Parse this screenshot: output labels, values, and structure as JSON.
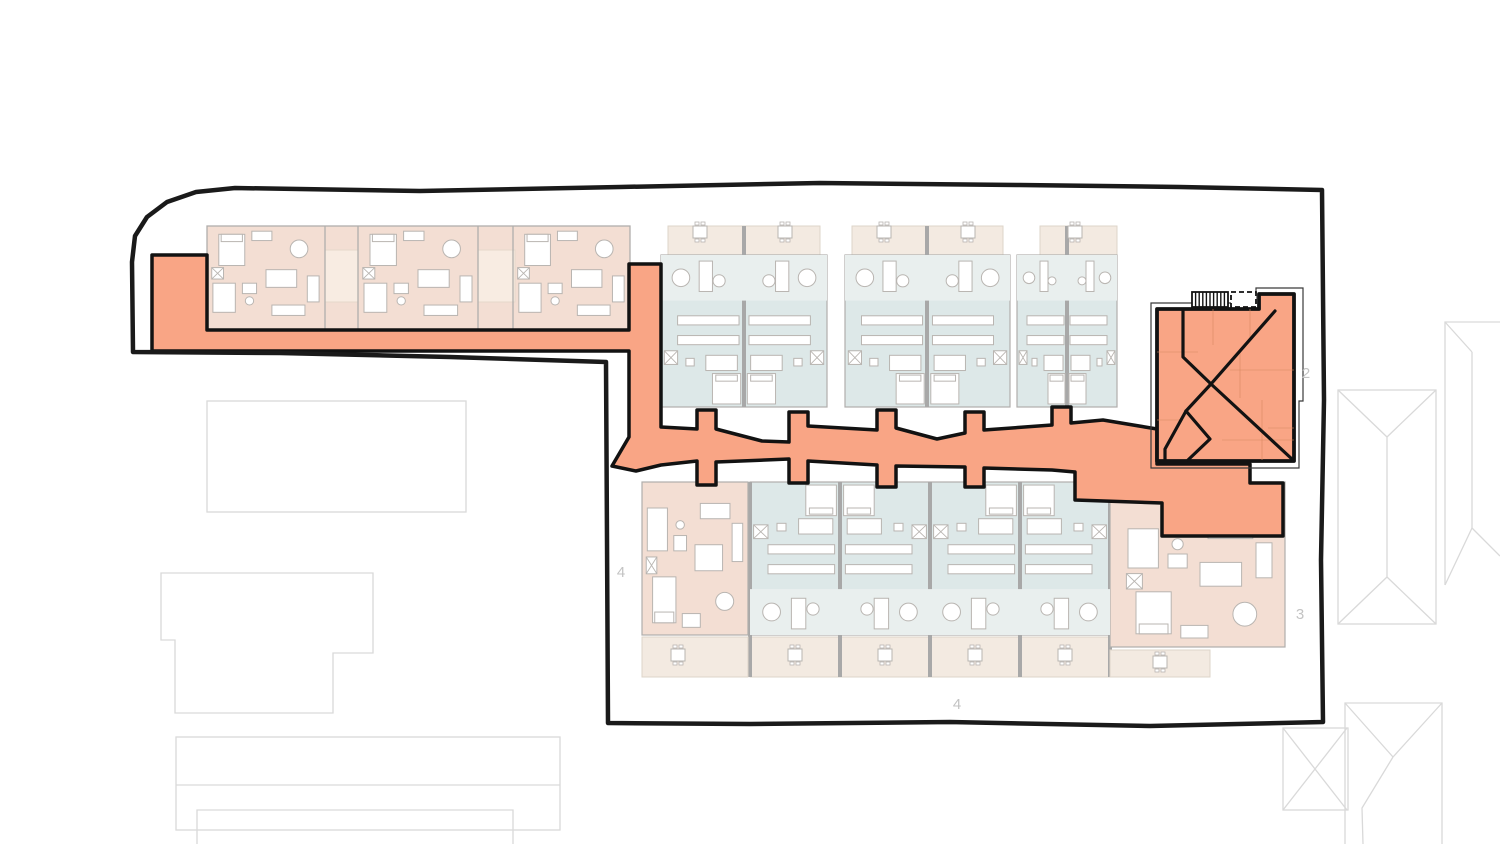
{
  "canvas": {
    "width": 1500,
    "height": 844,
    "background": "#ffffff"
  },
  "palette": {
    "boundary": "#1a1a1a",
    "orange_fill": "#f9a585",
    "orange_stroke": "#121212",
    "pink": "#f3ded3",
    "pink_light": "#f8ece2",
    "blue": "#dde8e8",
    "blue_light": "#e9efee",
    "terrace": "#f3eae1",
    "terrace_stroke": "#ded4c9",
    "wall": "#b0aeac",
    "wall_thick": "#a8a8a8",
    "furniture_fill": "#ffffff",
    "furniture_stroke": "#b9b5b1",
    "faint": "#d9d9d9",
    "label": "#c3c3c3",
    "building_inner_line": "#d98a63",
    "outer_thin": "#3a3a3a"
  },
  "labels": [
    {
      "text": "2",
      "x": 1306,
      "y": 378
    },
    {
      "text": "3",
      "x": 1300,
      "y": 619
    },
    {
      "text": "4",
      "x": 621,
      "y": 577
    },
    {
      "text": "4",
      "x": 957,
      "y": 709
    }
  ],
  "site_boundary": {
    "stroke_width": 4.5,
    "points": [
      [
        133,
        352
      ],
      [
        132,
        262
      ],
      [
        135,
        236
      ],
      [
        147,
        217
      ],
      [
        167,
        202
      ],
      [
        196,
        192
      ],
      [
        235,
        188
      ],
      [
        420,
        191
      ],
      [
        620,
        187
      ],
      [
        820,
        183
      ],
      [
        1020,
        185
      ],
      [
        1180,
        187
      ],
      [
        1322,
        190
      ],
      [
        1324,
        400
      ],
      [
        1321,
        560
      ],
      [
        1323,
        722
      ],
      [
        1150,
        726
      ],
      [
        950,
        722
      ],
      [
        750,
        724
      ],
      [
        608,
        723
      ],
      [
        607,
        540
      ],
      [
        606,
        362
      ],
      [
        450,
        357
      ],
      [
        280,
        353
      ]
    ]
  },
  "circulation": {
    "stroke_width": 3.5,
    "points": [
      [
        152,
        255
      ],
      [
        207,
        255
      ],
      [
        207,
        330
      ],
      [
        629,
        330
      ],
      [
        629,
        264
      ],
      [
        661,
        264
      ],
      [
        661,
        427
      ],
      [
        697,
        429
      ],
      [
        697,
        410
      ],
      [
        716,
        410
      ],
      [
        716,
        429
      ],
      [
        762,
        441
      ],
      [
        789,
        442
      ],
      [
        789,
        412
      ],
      [
        808,
        412
      ],
      [
        808,
        426
      ],
      [
        877,
        430
      ],
      [
        877,
        410
      ],
      [
        896,
        410
      ],
      [
        896,
        428
      ],
      [
        937,
        439
      ],
      [
        965,
        433
      ],
      [
        965,
        412
      ],
      [
        984,
        412
      ],
      [
        984,
        430
      ],
      [
        1052,
        425
      ],
      [
        1052,
        407
      ],
      [
        1071,
        407
      ],
      [
        1071,
        423
      ],
      [
        1103,
        420
      ],
      [
        1157,
        429
      ],
      [
        1157,
        464
      ],
      [
        1250,
        464
      ],
      [
        1250,
        483
      ],
      [
        1283,
        483
      ],
      [
        1283,
        536
      ],
      [
        1162,
        536
      ],
      [
        1162,
        503
      ],
      [
        1075,
        500
      ],
      [
        1075,
        472
      ],
      [
        1052,
        470
      ],
      [
        984,
        468
      ],
      [
        984,
        487
      ],
      [
        965,
        487
      ],
      [
        965,
        467
      ],
      [
        896,
        466
      ],
      [
        896,
        487
      ],
      [
        877,
        487
      ],
      [
        877,
        465
      ],
      [
        808,
        461
      ],
      [
        808,
        483
      ],
      [
        789,
        483
      ],
      [
        789,
        459
      ],
      [
        716,
        462
      ],
      [
        716,
        485
      ],
      [
        697,
        485
      ],
      [
        697,
        461
      ],
      [
        661,
        465
      ],
      [
        636,
        471
      ],
      [
        612,
        466
      ],
      [
        629,
        437
      ],
      [
        629,
        351
      ],
      [
        152,
        351
      ]
    ]
  },
  "building2": {
    "outer_outline": [
      [
        1151,
        468
      ],
      [
        1151,
        303
      ],
      [
        1256,
        303
      ],
      [
        1256,
        288
      ],
      [
        1303,
        288
      ],
      [
        1303,
        401
      ],
      [
        1299,
        401
      ],
      [
        1299,
        468
      ]
    ],
    "body": [
      [
        1157,
        309
      ],
      [
        1259,
        309
      ],
      [
        1259,
        294
      ],
      [
        1294,
        294
      ],
      [
        1294,
        461
      ],
      [
        1157,
        461
      ]
    ],
    "roof_lines": [
      [
        [
          1183,
          311
        ],
        [
          1183,
          357
        ],
        [
          1211,
          384
        ]
      ],
      [
        [
          1275,
          311
        ],
        [
          1211,
          384
        ]
      ],
      [
        [
          1211,
          384
        ],
        [
          1293,
          460
        ]
      ],
      [
        [
          1211,
          384
        ],
        [
          1186,
          411
        ]
      ],
      [
        [
          1186,
          411
        ],
        [
          1165,
          449
        ],
        [
          1165,
          460
        ]
      ],
      [
        [
          1186,
          411
        ],
        [
          1210,
          439
        ],
        [
          1188,
          460
        ]
      ]
    ],
    "interior_lines": [
      [
        [
          1213,
          309
        ],
        [
          1213,
          345
        ]
      ],
      [
        [
          1240,
          350
        ],
        [
          1240,
          398
        ]
      ],
      [
        [
          1157,
          352
        ],
        [
          1198,
          352
        ]
      ],
      [
        [
          1230,
          370
        ],
        [
          1294,
          370
        ]
      ],
      [
        [
          1157,
          420
        ],
        [
          1183,
          420
        ]
      ],
      [
        [
          1250,
          309
        ],
        [
          1250,
          338
        ]
      ],
      [
        [
          1222,
          440
        ],
        [
          1294,
          440
        ]
      ],
      [
        [
          1262,
          400
        ],
        [
          1262,
          460
        ]
      ],
      [
        [
          1294,
          428
        ],
        [
          1268,
          428
        ]
      ]
    ],
    "stair_hatch": {
      "x": 1192,
      "y": 292,
      "w": 36,
      "h": 15,
      "lines": 10
    },
    "dashed_box": {
      "x": 1231,
      "y": 292,
      "w": 25,
      "h": 15
    }
  },
  "wings": {
    "top_left": {
      "rect": [
        207,
        226,
        423,
        104
      ],
      "hatches": [
        [
          325,
          250,
          33,
          52
        ],
        [
          478,
          250,
          37,
          52
        ]
      ],
      "wall_x": [
        325,
        358,
        478,
        513
      ]
    },
    "top_pairs": [
      {
        "body": [
          661,
          255,
          166,
          152
        ],
        "divider": 744,
        "terrace": [
          668,
          226,
          152,
          29
        ],
        "tables": [
          [
            700,
            232
          ],
          [
            785,
            232
          ]
        ]
      },
      {
        "body": [
          845,
          255,
          165,
          152
        ],
        "divider": 927,
        "terrace": [
          852,
          226,
          151,
          29
        ],
        "tables": [
          [
            884,
            232
          ],
          [
            968,
            232
          ]
        ]
      },
      {
        "body": [
          1017,
          255,
          100,
          152
        ],
        "divider": 1067,
        "terrace": [
          1040,
          226,
          77,
          29
        ],
        "tables": [
          [
            1075,
            232
          ]
        ]
      }
    ],
    "bottom_blue": {
      "body": [
        750,
        482,
        360,
        153
      ],
      "dividers": [
        750,
        840,
        930,
        1020,
        1110
      ],
      "divider_y": [
        482,
        677
      ],
      "terraces": [
        [
          750,
          637,
          180,
          40
        ],
        [
          930,
          637,
          180,
          40
        ]
      ],
      "tables": [
        [
          795,
          655
        ],
        [
          885,
          655
        ],
        [
          975,
          655
        ],
        [
          1065,
          655
        ]
      ]
    },
    "bottom_pink_left": {
      "body": [
        642,
        482,
        106,
        153
      ],
      "terrace": [
        642,
        637,
        106,
        40
      ],
      "tables": [
        [
          678,
          655
        ]
      ]
    },
    "bottom_pink_right": {
      "body": [
        1110,
        482,
        175,
        165
      ],
      "terrace": [
        1110,
        650,
        100,
        27
      ],
      "tables": [
        [
          1160,
          662
        ]
      ]
    }
  },
  "furniture_stamps": [
    {
      "tpl": "pink_unit",
      "box": [
        207,
        226,
        118,
        104
      ],
      "flip": false
    },
    {
      "tpl": "pink_unit",
      "box": [
        358,
        226,
        120,
        104
      ],
      "flip": false
    },
    {
      "tpl": "pink_unit",
      "box": [
        513,
        226,
        117,
        104
      ],
      "flip": false
    },
    {
      "tpl": "blue_pair",
      "box": [
        661,
        255,
        166,
        152
      ],
      "flip": false
    },
    {
      "tpl": "blue_pair",
      "box": [
        845,
        255,
        165,
        152
      ],
      "flip": false
    },
    {
      "tpl": "blue_pair",
      "box": [
        1017,
        255,
        100,
        152
      ],
      "flip": false
    },
    {
      "tpl": "blue_pair",
      "box": [
        750,
        482,
        180,
        153
      ],
      "flip": true
    },
    {
      "tpl": "blue_pair",
      "box": [
        930,
        482,
        180,
        153
      ],
      "flip": true
    },
    {
      "tpl": "pink_unit",
      "box": [
        642,
        482,
        106,
        153
      ],
      "flip": true
    },
    {
      "tpl": "pink_unit",
      "box": [
        1120,
        505,
        160,
        140
      ],
      "flip": true
    }
  ],
  "furniture_templates": {
    "blue_pair": [
      {
        "t": "lrect",
        "x": 0,
        "y": 0,
        "w": 1,
        "h": 0.3
      },
      {
        "t": "rect",
        "x": 0.23,
        "y": 0.04,
        "w": 0.08,
        "h": 0.2
      },
      {
        "t": "rect",
        "x": 0.69,
        "y": 0.04,
        "w": 0.08,
        "h": 0.2
      },
      {
        "t": "circle",
        "cx": 0.12,
        "cy": 0.15,
        "r": 0.058
      },
      {
        "t": "circle",
        "cx": 0.88,
        "cy": 0.15,
        "r": 0.058
      },
      {
        "t": "circle",
        "cx": 0.35,
        "cy": 0.17,
        "r": 0.04
      },
      {
        "t": "circle",
        "cx": 0.65,
        "cy": 0.17,
        "r": 0.04
      },
      {
        "t": "rect",
        "x": 0.1,
        "y": 0.4,
        "w": 0.37,
        "h": 0.06
      },
      {
        "t": "rect",
        "x": 0.53,
        "y": 0.4,
        "w": 0.37,
        "h": 0.06
      },
      {
        "t": "rect",
        "x": 0.1,
        "y": 0.53,
        "w": 0.37,
        "h": 0.06
      },
      {
        "t": "rect",
        "x": 0.53,
        "y": 0.53,
        "w": 0.37,
        "h": 0.06
      },
      {
        "t": "rect",
        "x": 0.27,
        "y": 0.66,
        "w": 0.19,
        "h": 0.1
      },
      {
        "t": "rect",
        "x": 0.54,
        "y": 0.66,
        "w": 0.19,
        "h": 0.1
      },
      {
        "t": "xbox",
        "x": 0.02,
        "y": 0.63,
        "w": 0.08,
        "h": 0.09
      },
      {
        "t": "xbox",
        "x": 0.9,
        "y": 0.63,
        "w": 0.08,
        "h": 0.09
      },
      {
        "t": "rect",
        "x": 0.15,
        "y": 0.68,
        "w": 0.05,
        "h": 0.05
      },
      {
        "t": "rect",
        "x": 0.8,
        "y": 0.68,
        "w": 0.05,
        "h": 0.05
      },
      {
        "t": "rect",
        "x": 0.31,
        "y": 0.78,
        "w": 0.17,
        "h": 0.2
      },
      {
        "t": "rect",
        "x": 0.52,
        "y": 0.78,
        "w": 0.17,
        "h": 0.2
      },
      {
        "t": "rect",
        "x": 0.33,
        "y": 0.79,
        "w": 0.13,
        "h": 0.04
      },
      {
        "t": "rect",
        "x": 0.54,
        "y": 0.79,
        "w": 0.13,
        "h": 0.04
      }
    ],
    "pink_unit": [
      {
        "t": "rect",
        "x": 0.1,
        "y": 0.08,
        "w": 0.22,
        "h": 0.3
      },
      {
        "t": "rect",
        "x": 0.12,
        "y": 0.08,
        "w": 0.18,
        "h": 0.07
      },
      {
        "t": "rect",
        "x": 0.38,
        "y": 0.05,
        "w": 0.17,
        "h": 0.09
      },
      {
        "t": "circle",
        "cx": 0.78,
        "cy": 0.22,
        "r": 0.085
      },
      {
        "t": "rect",
        "x": 0.5,
        "y": 0.42,
        "w": 0.26,
        "h": 0.17
      },
      {
        "t": "rect",
        "x": 0.05,
        "y": 0.55,
        "w": 0.19,
        "h": 0.28
      },
      {
        "t": "rect",
        "x": 0.3,
        "y": 0.55,
        "w": 0.12,
        "h": 0.1
      },
      {
        "t": "circle",
        "cx": 0.36,
        "cy": 0.72,
        "r": 0.04
      },
      {
        "t": "rect",
        "x": 0.55,
        "y": 0.76,
        "w": 0.28,
        "h": 0.1
      },
      {
        "t": "rect",
        "x": 0.85,
        "y": 0.48,
        "w": 0.1,
        "h": 0.25
      },
      {
        "t": "xbox",
        "x": 0.04,
        "y": 0.4,
        "w": 0.1,
        "h": 0.11
      }
    ]
  },
  "neighbors": {
    "shapes": [
      {
        "t": "rect",
        "x": 207,
        "y": 401,
        "w": 259,
        "h": 111
      },
      {
        "t": "poly",
        "pts": [
          [
            161,
            573
          ],
          [
            373,
            573
          ],
          [
            373,
            653
          ],
          [
            333,
            653
          ],
          [
            333,
            713
          ],
          [
            175,
            713
          ],
          [
            175,
            640
          ],
          [
            161,
            640
          ]
        ],
        "closed": true
      },
      {
        "t": "rect",
        "x": 176,
        "y": 737,
        "w": 384,
        "h": 93
      },
      {
        "t": "line",
        "pts": [
          [
            176,
            785
          ],
          [
            560,
            785
          ]
        ]
      },
      {
        "t": "poly",
        "pts": [
          [
            197,
            844
          ],
          [
            197,
            810
          ],
          [
            513,
            810
          ],
          [
            513,
            844
          ]
        ],
        "closed": false
      },
      {
        "t": "rect",
        "x": 1338,
        "y": 390,
        "w": 98,
        "h": 234
      },
      {
        "t": "line",
        "pts": [
          [
            1338,
            390
          ],
          [
            1387,
            437
          ]
        ]
      },
      {
        "t": "line",
        "pts": [
          [
            1436,
            390
          ],
          [
            1387,
            437
          ]
        ]
      },
      {
        "t": "line",
        "pts": [
          [
            1387,
            437
          ],
          [
            1387,
            577
          ]
        ]
      },
      {
        "t": "line",
        "pts": [
          [
            1338,
            624
          ],
          [
            1387,
            577
          ]
        ]
      },
      {
        "t": "line",
        "pts": [
          [
            1436,
            624
          ],
          [
            1387,
            577
          ]
        ]
      },
      {
        "t": "poly",
        "pts": [
          [
            1445,
            585
          ],
          [
            1445,
            322
          ],
          [
            1500,
            322
          ]
        ],
        "closed": false
      },
      {
        "t": "line",
        "pts": [
          [
            1445,
            322
          ],
          [
            1472,
            352
          ]
        ]
      },
      {
        "t": "line",
        "pts": [
          [
            1472,
            352
          ],
          [
            1472,
            528
          ]
        ]
      },
      {
        "t": "line",
        "pts": [
          [
            1445,
            585
          ],
          [
            1472,
            528
          ]
        ]
      },
      {
        "t": "line",
        "pts": [
          [
            1500,
            556
          ],
          [
            1472,
            528
          ]
        ]
      },
      {
        "t": "rect",
        "x": 1283,
        "y": 728,
        "w": 65,
        "h": 82
      },
      {
        "t": "line",
        "pts": [
          [
            1283,
            728
          ],
          [
            1347,
            810
          ]
        ]
      },
      {
        "t": "line",
        "pts": [
          [
            1347,
            728
          ],
          [
            1283,
            810
          ]
        ]
      },
      {
        "t": "poly",
        "pts": [
          [
            1345,
            844
          ],
          [
            1345,
            703
          ],
          [
            1442,
            703
          ],
          [
            1442,
            844
          ]
        ],
        "closed": false
      },
      {
        "t": "line",
        "pts": [
          [
            1345,
            703
          ],
          [
            1393,
            757
          ]
        ]
      },
      {
        "t": "line",
        "pts": [
          [
            1442,
            703
          ],
          [
            1393,
            757
          ]
        ]
      },
      {
        "t": "poly",
        "pts": [
          [
            1393,
            757
          ],
          [
            1362,
            808
          ],
          [
            1363,
            844
          ]
        ],
        "closed": false
      }
    ]
  }
}
